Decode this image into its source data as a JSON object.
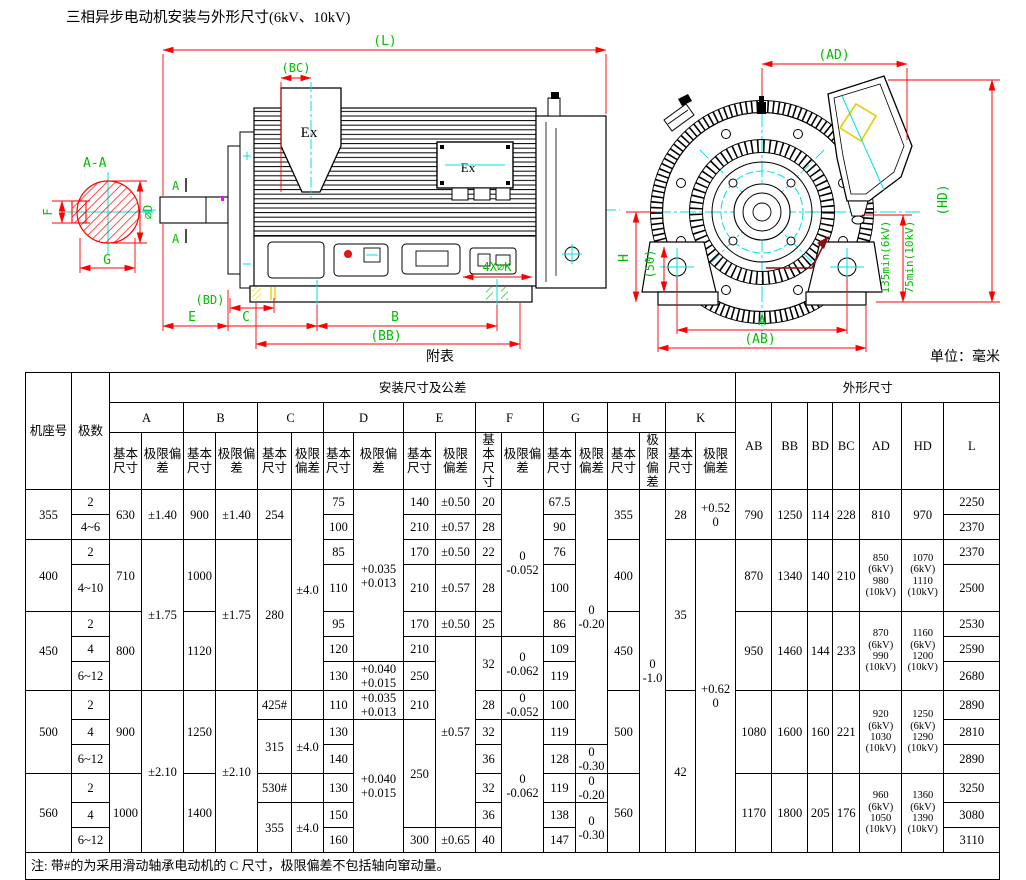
{
  "title": "三相异步电动机安装与外形尺寸(6kV、10kV)",
  "caption": "附表",
  "unit": "单位：毫米",
  "labels": {
    "section": "A-A",
    "dia_d": "⌀D",
    "dim_g": "G",
    "dim_f": "F",
    "mark_a1": "A",
    "mark_a2": "A",
    "ex_top": "Ex",
    "ex_side": "Ex",
    "dim_l": "(L)",
    "dim_bc": "(BC)",
    "dim_bd": "(BD)",
    "dim_e": "E",
    "dim_c": "C",
    "dim_b": "B",
    "dim_bb": "(BB)",
    "holes": "4X⌀K",
    "dim_ad": "(AD)",
    "dim_hd": "(HD)",
    "dim_h": "H",
    "dim_50": "(50)",
    "dim_a": "A",
    "dim_ab": "(AB)",
    "min6kv": "135min(6kV)",
    "min10kv": "75min(10kV)"
  },
  "table": {
    "col_frame": "机座号",
    "col_poles": "极数",
    "grp_mount": "安装尺寸及公差",
    "grp_outline": "外形尺寸",
    "sub_basic": "基本尺寸",
    "sub_dev": "极限偏差",
    "dims": [
      "A",
      "B",
      "C",
      "D",
      "E",
      "F",
      "G",
      "H",
      "K"
    ],
    "outer": [
      "AB",
      "BB",
      "BD",
      "BC",
      "AD",
      "HD",
      "L"
    ],
    "rows": [
      {
        "cells": [
          [
            "355",
            2
          ],
          [
            "2"
          ],
          [
            "630",
            2
          ],
          [
            "±1.40",
            2
          ],
          [
            "900",
            2
          ],
          [
            "±1.40",
            2
          ],
          [
            "254",
            2
          ],
          [
            "±4.0",
            7
          ],
          [
            "75"
          ],
          [
            "+0.035\n+0.013",
            6
          ],
          [
            "140"
          ],
          [
            "±0.50"
          ],
          [
            "20"
          ],
          [
            "0\n-0.052",
            5
          ],
          [
            "67.5"
          ],
          [
            "0\n-0.20",
            9
          ],
          [
            "355",
            2
          ],
          [
            "0\n-1.0",
            13
          ],
          [
            "28",
            2
          ],
          [
            "+0.52\n0",
            2
          ],
          [
            "790",
            2
          ],
          [
            "1250",
            2
          ],
          [
            "114",
            2
          ],
          [
            "228",
            2
          ],
          [
            "810",
            2
          ],
          [
            "970",
            2
          ],
          [
            "2250"
          ]
        ]
      },
      {
        "cells": [
          [
            "4~6"
          ],
          [
            "100"
          ],
          [
            "210"
          ],
          [
            "±0.57"
          ],
          [
            "28"
          ],
          [
            "90"
          ],
          [
            "2370"
          ]
        ]
      },
      {
        "cells": [
          [
            "400",
            2
          ],
          [
            "2"
          ],
          [
            "710",
            2
          ],
          [
            "±1.75",
            5
          ],
          [
            "1000",
            2
          ],
          [
            "±1.75",
            5
          ],
          [
            "280",
            5
          ],
          [
            "85"
          ],
          [
            "170"
          ],
          [
            "±0.50"
          ],
          [
            "22"
          ],
          [
            "76"
          ],
          [
            "400",
            2
          ],
          [
            "35",
            5
          ],
          [
            "+0.62\n0",
            11
          ],
          [
            "870",
            2
          ],
          [
            "1340",
            2
          ],
          [
            "140",
            2
          ],
          [
            "210",
            2
          ],
          [
            "850\n(6kV)\n980\n(10kV)",
            2,
            "kv"
          ],
          [
            "1070\n(6kV)\n1110\n(10kV)",
            2,
            "kv"
          ],
          [
            "2370"
          ]
        ]
      },
      {
        "h": 47,
        "cells": [
          [
            "4~10"
          ],
          [
            "110"
          ],
          [
            "210"
          ],
          [
            "±0.57"
          ],
          [
            "28"
          ],
          [
            "100"
          ],
          [
            "2500"
          ]
        ]
      },
      {
        "cells": [
          [
            "450",
            3
          ],
          [
            "2"
          ],
          [
            "800",
            3
          ],
          [
            "1120",
            3
          ],
          [
            "95"
          ],
          [
            "170"
          ],
          [
            "±0.50"
          ],
          [
            "25"
          ],
          [
            "86"
          ],
          [
            "450",
            3
          ],
          [
            "950",
            3
          ],
          [
            "1460",
            3
          ],
          [
            "144",
            3
          ],
          [
            "233",
            3
          ],
          [
            "870\n(6kV)\n990\n(10kV)",
            3,
            "kv"
          ],
          [
            "1160\n(6kV)\n1200\n(10kV)",
            3,
            "kv"
          ],
          [
            "2530"
          ]
        ]
      },
      {
        "cells": [
          [
            "4"
          ],
          [
            "120"
          ],
          [
            "210"
          ],
          [
            "±0.57",
            7
          ],
          [
            "32",
            2
          ],
          [
            "0\n-0.062",
            2
          ],
          [
            "109"
          ],
          [
            "2590"
          ]
        ]
      },
      {
        "cells": [
          [
            "6~12"
          ],
          [
            "130"
          ],
          [
            "+0.040\n+0.015"
          ],
          [
            "250"
          ],
          [
            "119"
          ],
          [
            "2680"
          ]
        ]
      },
      {
        "cells": [
          [
            "500",
            3
          ],
          [
            "2"
          ],
          [
            "900",
            3
          ],
          [
            "±2.10",
            6
          ],
          [
            "1250",
            3
          ],
          [
            "±2.10",
            6
          ],
          [
            "425#"
          ],
          [
            ""
          ],
          [
            "110"
          ],
          [
            "+0.035\n+0.013"
          ],
          [
            "210"
          ],
          [
            "28"
          ],
          [
            "0\n-0.052"
          ],
          [
            "100"
          ],
          [
            "500",
            3
          ],
          [
            "42",
            6
          ],
          [
            "1080",
            3
          ],
          [
            "1600",
            3
          ],
          [
            "160",
            3
          ],
          [
            "221",
            3
          ],
          [
            "920\n(6kV)\n1030\n(10kV)",
            3,
            "kv"
          ],
          [
            "1250\n(6kV)\n1290\n(10kV)",
            3,
            "kv"
          ],
          [
            "2890"
          ]
        ]
      },
      {
        "cells": [
          [
            "4"
          ],
          [
            "315",
            2
          ],
          [
            "±4.0",
            2
          ],
          [
            "130"
          ],
          [
            "+0.040\n+0.015",
            5
          ],
          [
            "250",
            4
          ],
          [
            "32"
          ],
          [
            "0\n-0.062",
            5
          ],
          [
            "119"
          ],
          [
            "2810"
          ]
        ]
      },
      {
        "cells": [
          [
            "6~12"
          ],
          [
            "140"
          ],
          [
            "36"
          ],
          [
            "128"
          ],
          [
            "0\n-0.30"
          ],
          [
            "2890"
          ]
        ]
      },
      {
        "cells": [
          [
            "560",
            3
          ],
          [
            "2"
          ],
          [
            "1000",
            3
          ],
          [
            "1400",
            3
          ],
          [
            "530#"
          ],
          [
            ""
          ],
          [
            "130"
          ],
          [
            "32"
          ],
          [
            "119"
          ],
          [
            "0\n-0.20"
          ],
          [
            "560",
            3
          ],
          [
            "1170",
            3
          ],
          [
            "1800",
            3
          ],
          [
            "205",
            3
          ],
          [
            "176",
            3
          ],
          [
            "960\n(6kV)\n1050\n(10kV)",
            3,
            "kv"
          ],
          [
            "1360\n(6kV)\n1390\n(10kV)",
            3,
            "kv"
          ],
          [
            "3250"
          ]
        ]
      },
      {
        "cells": [
          [
            "4"
          ],
          [
            "355",
            2
          ],
          [
            "±4.0",
            2
          ],
          [
            "150"
          ],
          [
            "36"
          ],
          [
            "138"
          ],
          [
            "0\n-0.30",
            2
          ],
          [
            "3080"
          ]
        ]
      },
      {
        "cells": [
          [
            "6~12"
          ],
          [
            "160"
          ],
          [
            "300"
          ],
          [
            "±0.65"
          ],
          [
            "40"
          ],
          [
            "147"
          ],
          [
            "3110"
          ]
        ]
      }
    ],
    "note": "注: 带#的为采用滑动轴承电动机的 C 尺寸，极限偏差不包括轴向窜动量。"
  }
}
